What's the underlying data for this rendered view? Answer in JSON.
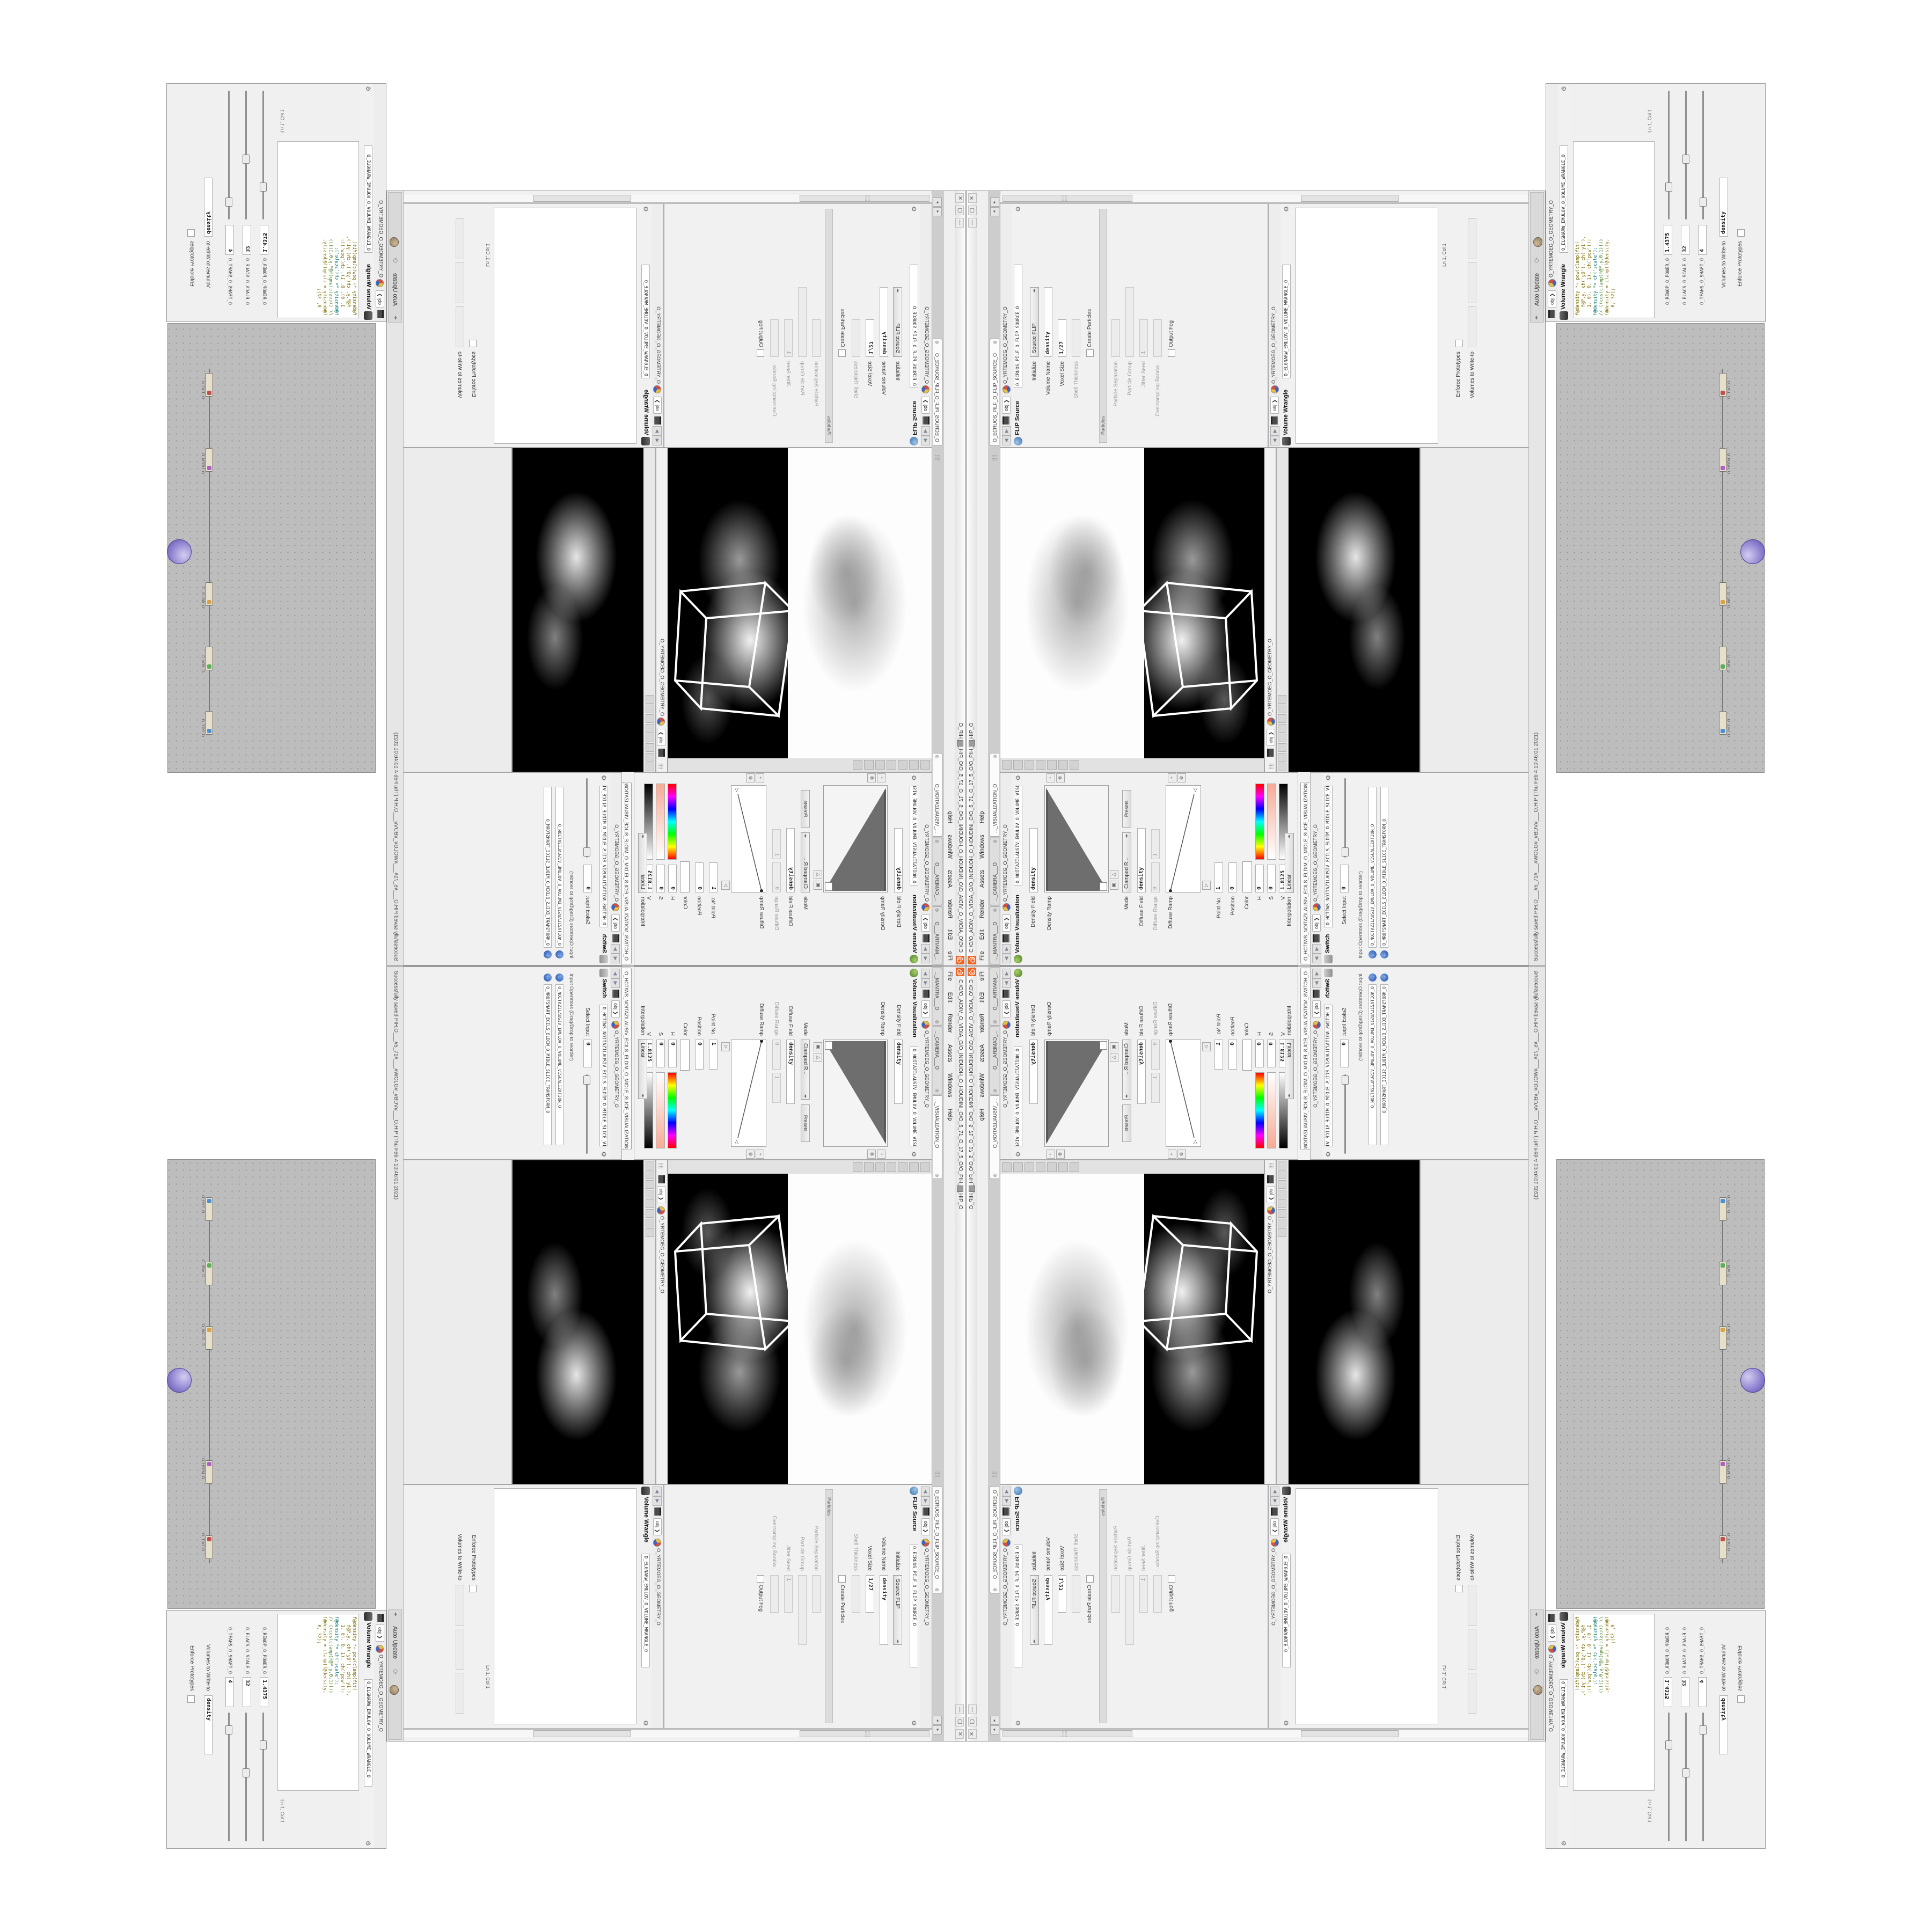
{
  "icons": {
    "close_tab": "⊗",
    "gear": "⚙",
    "plus": "+",
    "del": "⊗",
    "tri_open": "△",
    "tri_mark": "▣",
    "back": "◀",
    "fwd": "▶",
    "chevron": "❯",
    "grip": "⣿⣿",
    "left_scroll": "◂",
    "right_scroll": "▸",
    "win_min": "—",
    "win_max": "▢",
    "win_close": "✕",
    "recycle": "⟳",
    "blue_jump": "←",
    "marker_left": "◁",
    "marker_right": "▷",
    "dd": "◂▸"
  },
  "title_bar": {
    "title": "C:/O/O_AIDIV_O_VIDIA_O/O_INIDUOH_O_HOUDINI_O/O_5_71_O_17_5_O/O_PIH_O_HIP_O"
  },
  "menu_bar": {
    "items": [
      "File",
      "Edit",
      "Render",
      "Assets",
      "Windows",
      "Help"
    ]
  },
  "tab_bar": {
    "tabs": [
      "..._MANTRA___O",
      "..._CAMERA___O",
      "..._VISUALIZATION_O",
      "O_ECRUOS_PILF_O_FLIP_SOURCE_O"
    ]
  },
  "path_bar": {
    "context": "obj",
    "node": "O_YRTEMOEG_O_GEOMETRY_O"
  },
  "volviz": {
    "title": "Volume Visualization",
    "name": "O_NOITAZILAUSIV_EMULOV_O_VOLUME_VISUALIZATION_O",
    "density_field": {
      "label": "Density Field",
      "value": "density"
    },
    "density_ramp_label": "Density Ramp",
    "mode": {
      "label": "Mode",
      "value": "Clamped R...",
      "presets": "Presets"
    },
    "diffuse_field": {
      "label": "Diffuse Field",
      "value": "density"
    },
    "diffuse_range": {
      "label": "Diffuse Range",
      "min": "0",
      "max": "1"
    },
    "diffuse_ramp_label": "Diffuse Ramp",
    "point_no": {
      "label": "Point No.",
      "value": "1"
    },
    "position": {
      "label": "Position",
      "value": "0"
    },
    "color_label": "Color",
    "h": {
      "label": "H",
      "value": "0"
    },
    "s": {
      "label": "S",
      "value": "0"
    },
    "v": {
      "label": "V",
      "value": "1.8125"
    },
    "interpolation": {
      "label": "Interpolation",
      "value": "Linear"
    }
  },
  "switch": {
    "tab": "O_HCTIWS_NOITAZILAUSIV_ECILS_ELDIM_O_MIDLE_SLICE_VISUALIZATION_SWITCH_O",
    "title": "Switch",
    "name": "O_HCTIWS_NOITAZILAUSIV_ECILS_ELDIM_O_MIDLE_SLICE_VISUALIZATION_SWITCH_O",
    "select_input": {
      "label": "Select Input",
      "value": "0"
    },
    "input_ops_label": "Input Operators (Drag/Drop to reorder)",
    "inputs": [
      "O_NOITAZILAUSIV_EMULOV_O_VOLUME_VISUALIZATION_O",
      "O_MROFSNART_ECILS_ELDIM_O_MIDLE_SLICE_TRANSFORM_O"
    ]
  },
  "flip_source": {
    "title": "FLIP Source",
    "name": "O_ECRUOS_PILF_O_FLIP_SOURCE_O",
    "rows": [
      {
        "label": "Initialize",
        "value": "Source FLIP"
      },
      {
        "label": "Volume Name",
        "value": "density"
      },
      {
        "label": "Voxel Size",
        "value": "1/27"
      },
      {
        "label": "Shell Thickness",
        "value": ""
      },
      {
        "label": "Create Particles",
        "value": ""
      },
      {
        "label": "Particle Separation",
        "value": ""
      },
      {
        "label": "Particle Group",
        "value": ""
      },
      {
        "label": "Jitter Seed",
        "value": "1"
      },
      {
        "label": "Oversampling Bandw...",
        "value": ""
      },
      {
        "label": "Output Fog",
        "value": ""
      }
    ],
    "particles_section": "Particles"
  },
  "wrangle1": {
    "title": "Volume Wrangle",
    "name": "O_ELGNARW_EMULOV_O_VOLUME_WRANGLE_O",
    "ln_col": "Ln 1, Col 1",
    "enforce": "Enforce Prototypes",
    "volumes_label": "Volumes to Write-to"
  },
  "wrangle2": {
    "title": "Volume Wrangle",
    "name": "O_ELGNARW_EMULOV_O_VOLUME_WRANGLE_O",
    "ln_col": "Ln 1, Col 1",
    "enforce": "Enforce Prototypes",
    "volumes_label": "Volumes to Write-to",
    "volumes_value": "density",
    "code": [
      "f@density *= pow(clamp(fit(",
      "   f@P.y, ch('y0'), ch('y1'),",
      "   1, 0), 0, 1), ch('pow'));",
      "f@density *= ch('scale');",
      "// ((cos(clamp(f@P.y,0,1))))",
      "f@density = clamp(f@density,",
      "   0, 32);"
    ],
    "sliders": [
      {
        "label": "O_REWOP_O_POWER_O",
        "value": "1.4375"
      },
      {
        "label": "O_ELACS_O_SCALE_O",
        "value": "32"
      },
      {
        "label": "O_TFAHS_O_SHAFT_O",
        "value": "4"
      }
    ]
  },
  "status_bar": {
    "message": "Successfully saved PIH.O___#5_71#___#WOLG#_#BDV#___O.HIP (Thu Feb  4 10:46:01 2021)",
    "auto_update": "Auto Update"
  },
  "network": {
    "nodes": [
      "O_PILF_O",
      "O_BDV_O",
      "O_WOLG_O",
      "O_HSEM_O",
      "O_TUO_O"
    ]
  }
}
